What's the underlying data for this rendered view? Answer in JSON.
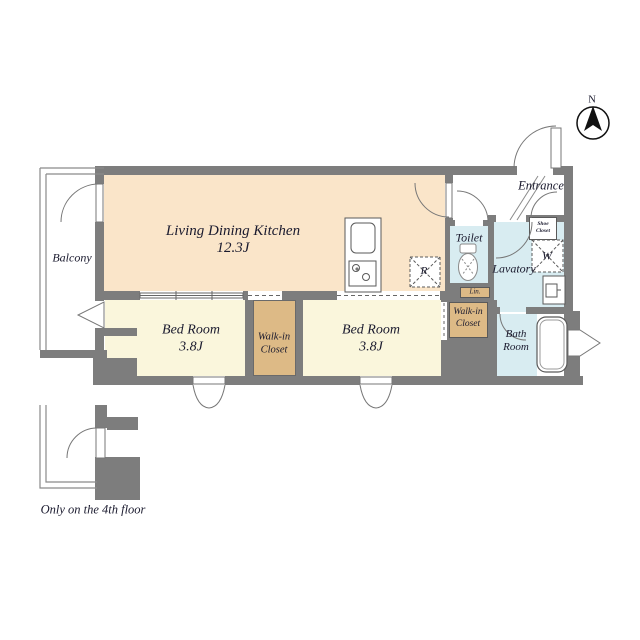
{
  "colors": {
    "wall": "#7d7d7d",
    "ldk_fill": "#fae5c9",
    "bedroom_fill": "#faf6dc",
    "closet_fill": "#ddba86",
    "wet_fill": "#d8ecf1",
    "line": "#777777",
    "text": "#1a1a2e"
  },
  "compass": {
    "north_label": "N"
  },
  "rooms": {
    "ldk": {
      "name": "Living Dining Kitchen",
      "size": "12.3J"
    },
    "bedroom1": {
      "name": "Bed Room",
      "size": "3.8J"
    },
    "bedroom2": {
      "name": "Bed Room",
      "size": "3.8J"
    },
    "walkin_closet_middle": {
      "line1": "Walk-in",
      "line2": "Closet"
    },
    "walkin_closet_right": {
      "line1": "Walk-in",
      "line2": "Closet"
    },
    "balcony": {
      "name": "Balcony"
    },
    "entrance": {
      "name": "Entrance"
    },
    "toilet": {
      "name": "Toilet"
    },
    "lavatory": {
      "name": "Lavatory"
    },
    "bathroom": {
      "line1": "Bath",
      "line2": "Room"
    },
    "shoe_closet": {
      "line1": "Shoe",
      "line2": "Closet"
    },
    "linen": {
      "abbr": "Lin."
    },
    "washer": {
      "abbr": "W"
    },
    "refrigerator": {
      "abbr": "R"
    }
  },
  "footnote": "Only on the 4th floor"
}
